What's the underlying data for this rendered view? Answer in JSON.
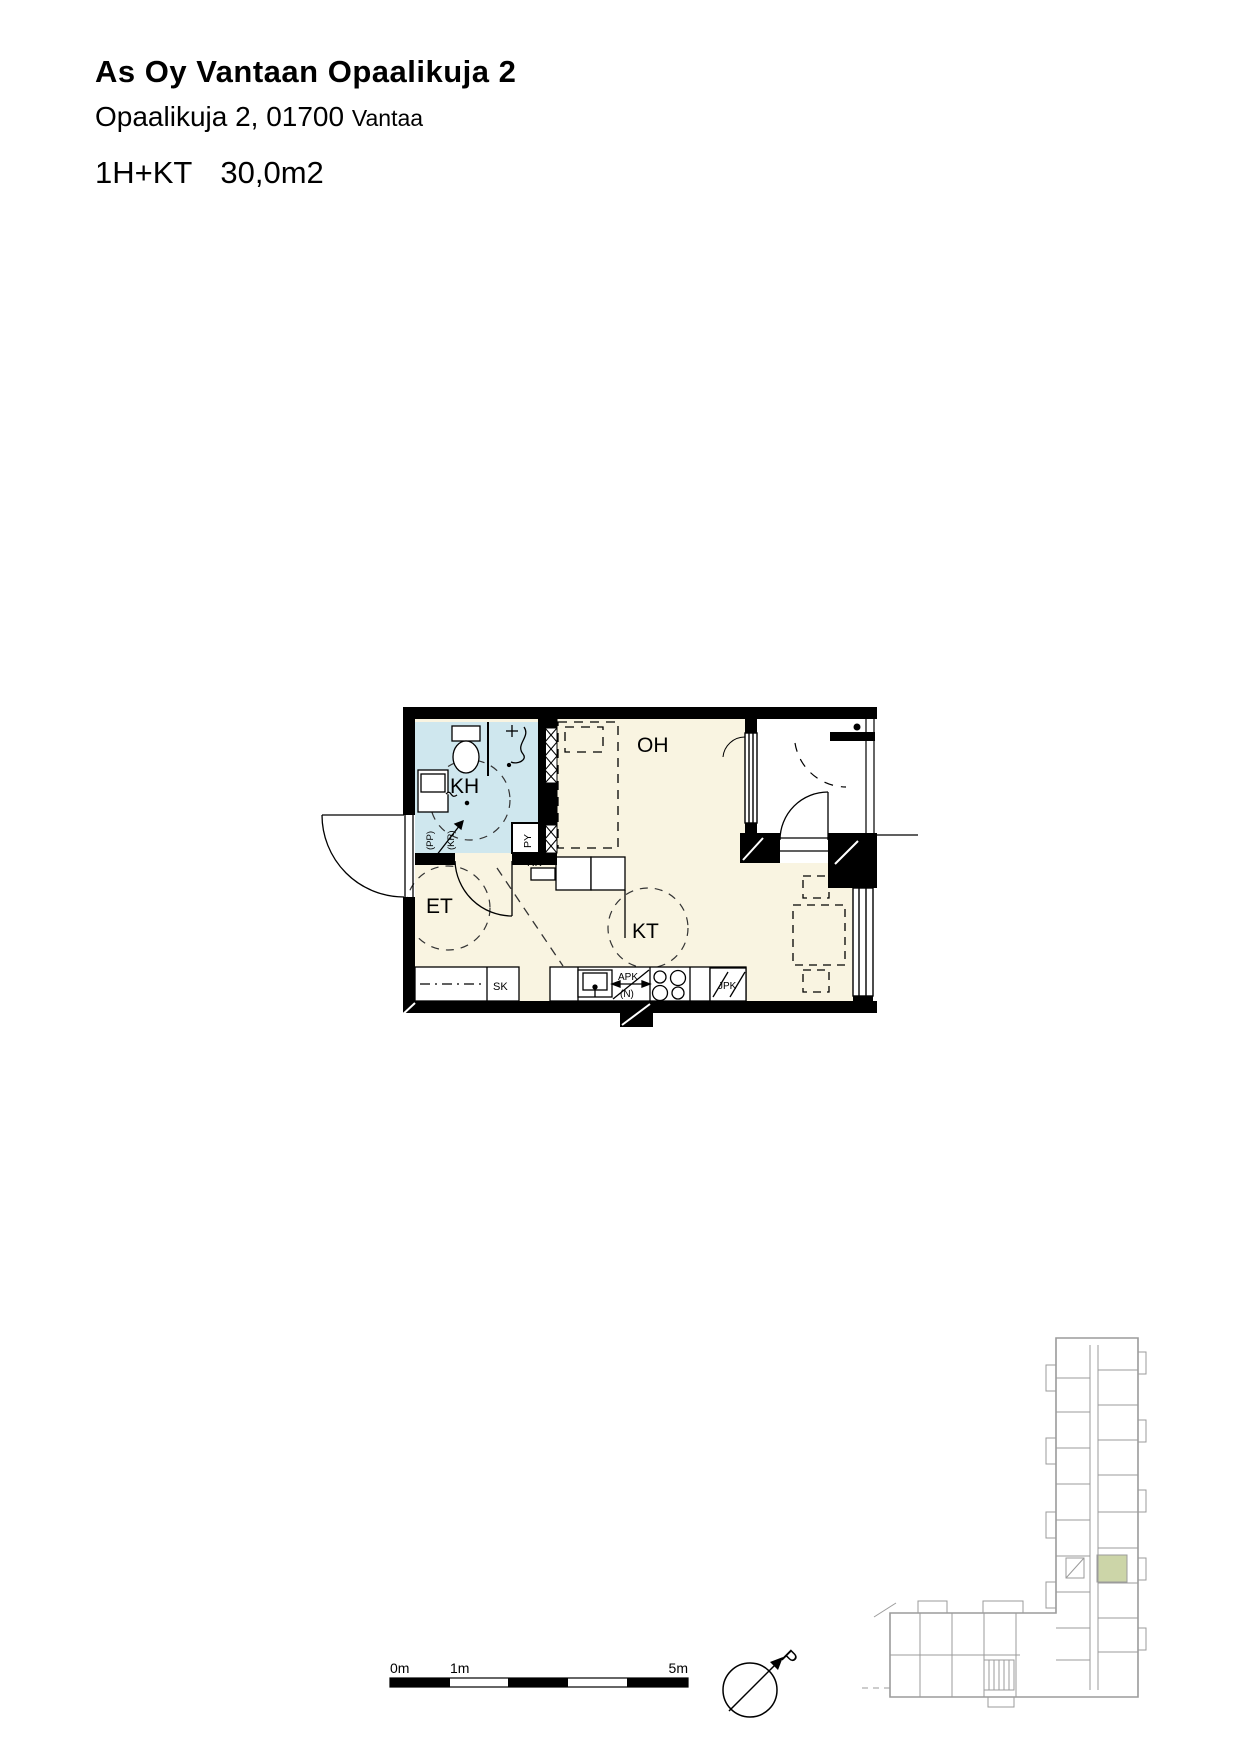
{
  "document": {
    "title": "As Oy Vantaan Opaalikuja 2",
    "address_line": "Opaalikuja 2, 01700",
    "address_city": "Vantaa",
    "unit_type": "1H+KT",
    "unit_area": "30,0m2"
  },
  "floorplan": {
    "room_labels": {
      "living": "OH",
      "bathroom": "KH",
      "entry": "ET",
      "kitchen": "KT"
    },
    "fixture_labels": {
      "cleaning_closet": "SK",
      "electrical_panel": "RK",
      "washer_reservation": "PY",
      "pp": "(PP)",
      "kr": "(KR)",
      "dishwasher": "APK",
      "dishwasher_sub": "(N)",
      "fridge": "JPK"
    },
    "colors": {
      "floor": "#f9f4e1",
      "bathroom_floor": "#cfe7ee",
      "wall": "#000000"
    }
  },
  "scale_bar": {
    "labels": [
      "0m",
      "1m",
      "5m"
    ]
  },
  "compass": {
    "north": "P"
  },
  "site_plan": {
    "highlight_color": "#ccd5a8",
    "line_color": "#9b9b9b"
  }
}
